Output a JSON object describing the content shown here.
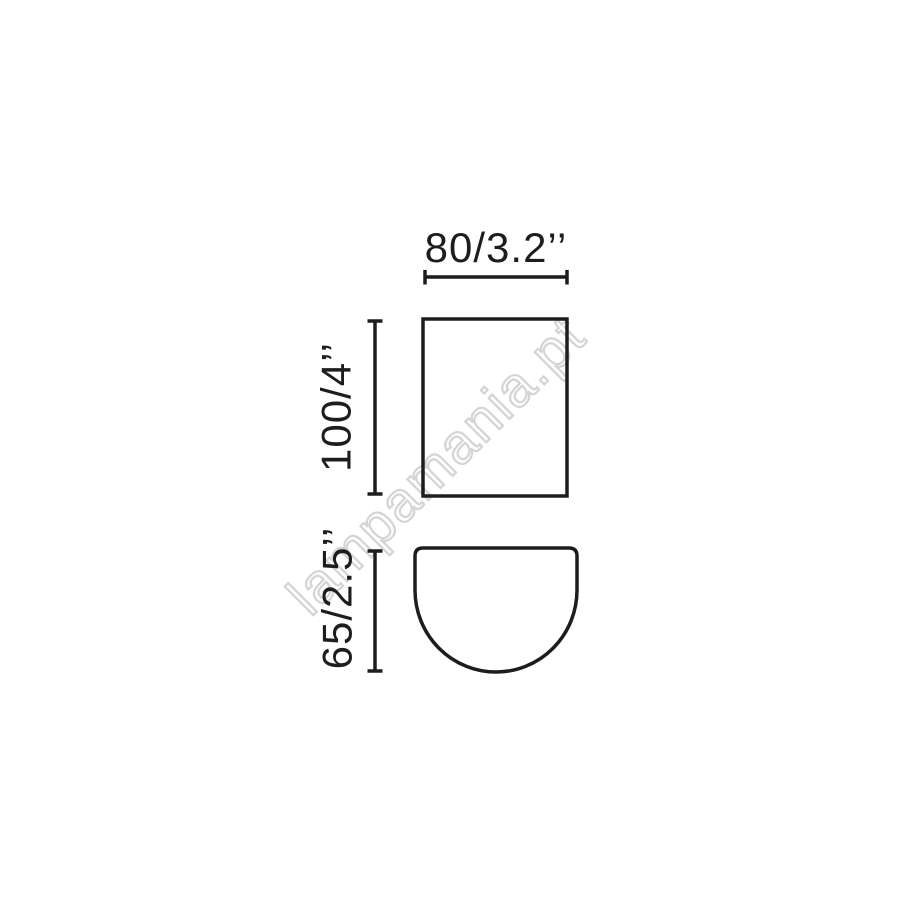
{
  "colors": {
    "line": "#1d1d1b",
    "watermark": "#d4d4d4",
    "background": "#ffffff"
  },
  "diagram": {
    "watermark": "lampamania.pt",
    "dimensions": {
      "width_label": "80/3.2’’",
      "height_label": "100/4’’",
      "depth_label": "65/2.5’’"
    }
  }
}
